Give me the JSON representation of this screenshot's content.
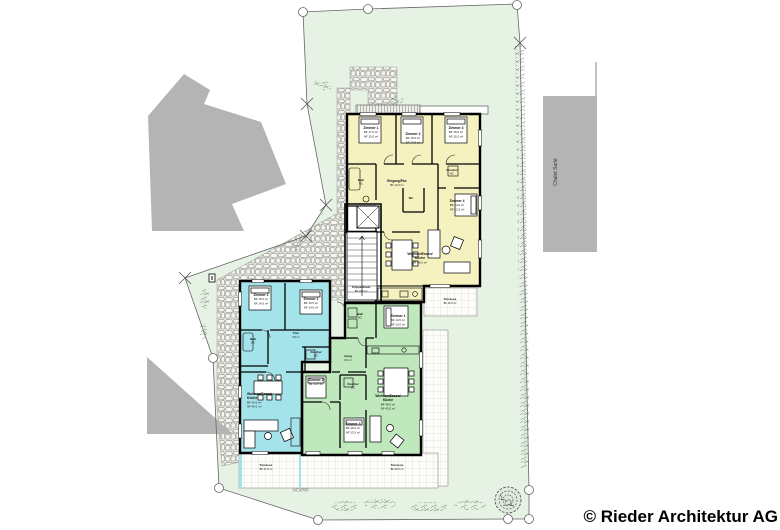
{
  "site": {
    "copyright": "© Rieder Architektur AG",
    "neighbor_label": "Chalet Sarlé",
    "plan_type": "Grundriss / Situationsplan"
  },
  "colors": {
    "parcel_green": "#e6f3e4",
    "unit_yellow": "#f6f2c0",
    "unit_cyan": "#a5e3eb",
    "unit_green": "#bfe9bd",
    "neighbor_gray": "#b4b4b4",
    "wall_black": "#000000",
    "stone_fill": "#f3f3ef",
    "tile_line": "#c9c9c4",
    "hedge_green": "#7d8e7d"
  },
  "units": {
    "yellow": {
      "name": "Attikawohnung (gelb)"
    },
    "cyan": {
      "name": "Wohnung West (blau)"
    },
    "green": {
      "name": "Wohnung Ost (grün)"
    }
  },
  "plan_labels": [
    {
      "id": "y-zimmer1",
      "x": 371,
      "y": 129,
      "lines": [
        "Zimmer 1",
        "BF 17.0 m²",
        "NF 15.5 m²"
      ]
    },
    {
      "id": "y-zimmer2",
      "x": 413,
      "y": 135,
      "lines": [
        "Zimmer 2",
        "BF 15.0 m²",
        "NF 13.5 m²"
      ]
    },
    {
      "id": "y-zimmer3",
      "x": 456,
      "y": 129,
      "lines": [
        "Zimmer 3",
        "BF 16.5 m²",
        "NF 15.0 m²"
      ]
    },
    {
      "id": "y-bad",
      "x": 361,
      "y": 181,
      "size": 2.9,
      "lines": [
        "Bad/",
        "WC"
      ]
    },
    {
      "id": "y-eingang",
      "x": 397,
      "y": 182,
      "size": 3.2,
      "lines": [
        "Eingang/Flur",
        "BF 12.5 m²"
      ]
    },
    {
      "id": "y-dusche",
      "x": 452,
      "y": 171,
      "size": 2.8,
      "lines": [
        "Dusche/",
        "WC"
      ]
    },
    {
      "id": "y-wc",
      "x": 411,
      "y": 199,
      "size": 2.8,
      "lines": [
        "WC"
      ]
    },
    {
      "id": "y-zimmer4",
      "x": 457,
      "y": 202,
      "lines": [
        "Zimmer 4",
        "BF 14.0 m²",
        "NF 12.5 m²"
      ]
    },
    {
      "id": "y-wohnen",
      "x": 420,
      "y": 255,
      "bold": 2,
      "lines": [
        "Wohnen/Essen/",
        "Küche",
        "BF 46.0 m²"
      ]
    },
    {
      "id": "y-terrasse",
      "x": 450,
      "y": 300,
      "size": 3.1,
      "lines": [
        "Terrasse",
        "BF 16.0 m²"
      ]
    },
    {
      "id": "treppenhaus",
      "x": 361,
      "y": 288,
      "size": 3.0,
      "lines": [
        "Treppenhaus",
        "BF 14.5 m²"
      ]
    },
    {
      "id": "c-zimmer2",
      "x": 261,
      "y": 296,
      "lines": [
        "Zimmer 2",
        "BF 16.0 m²",
        "NF 14.5 m²"
      ]
    },
    {
      "id": "c-zimmer1",
      "x": 311,
      "y": 300,
      "lines": [
        "Zimmer 1",
        "BF 15.5 m²",
        "NF 14.0 m²"
      ]
    },
    {
      "id": "c-bad",
      "x": 253,
      "y": 340,
      "size": 2.8,
      "lines": [
        "Bad/",
        "WC"
      ]
    },
    {
      "id": "c-flur",
      "x": 296,
      "y": 334,
      "size": 3.0,
      "lines": [
        "Flur",
        "9.5 m²"
      ]
    },
    {
      "id": "c-dusche",
      "x": 316,
      "y": 353,
      "size": 2.8,
      "lines": [
        "Dusche/",
        "WC"
      ]
    },
    {
      "id": "c-wohnen",
      "x": 247,
      "y": 395,
      "anchor": "start",
      "bold": 2,
      "lines": [
        "Wohnen/Essen/",
        "Küche",
        "BF 42.5 m²",
        "NF 40.0 m²"
      ]
    },
    {
      "id": "g-bad",
      "x": 360,
      "y": 315,
      "size": 2.8,
      "lines": [
        "Bad/",
        "WC"
      ]
    },
    {
      "id": "g-zimmer1",
      "x": 398,
      "y": 317,
      "lines": [
        "Zimmer 1",
        "BF 14.5 m²",
        "NF 13.0 m²"
      ]
    },
    {
      "id": "g-gang",
      "x": 348,
      "y": 357,
      "size": 3.0,
      "lines": [
        "Gang",
        "8.0 m²"
      ]
    },
    {
      "id": "g-dusche",
      "x": 353,
      "y": 385,
      "size": 2.8,
      "lines": [
        "Dusche/",
        "WC"
      ]
    },
    {
      "id": "g-zimmer2",
      "x": 316,
      "y": 381,
      "lines": [
        "Zimmer 2",
        "BF 13.5 m²"
      ]
    },
    {
      "id": "g-zimmer3",
      "x": 353,
      "y": 425,
      "lines": [
        "Zimmer 3",
        "BF 15.0 m²",
        "NF 13.5 m²"
      ]
    },
    {
      "id": "g-wohnen",
      "x": 388,
      "y": 397,
      "bold": 2,
      "lines": [
        "Wohnen/Essen/",
        "Küche",
        "BF 48.5 m²",
        "NF 45.5 m²"
      ]
    },
    {
      "id": "terrasse-west",
      "x": 266,
      "y": 466,
      "size": 3.1,
      "lines": [
        "Terrasse",
        "BF 27.0 m²"
      ]
    },
    {
      "id": "terrasse-ost",
      "x": 397,
      "y": 466,
      "size": 3.1,
      "lines": [
        "Terrasse",
        "BF 30.5 m²"
      ]
    }
  ]
}
